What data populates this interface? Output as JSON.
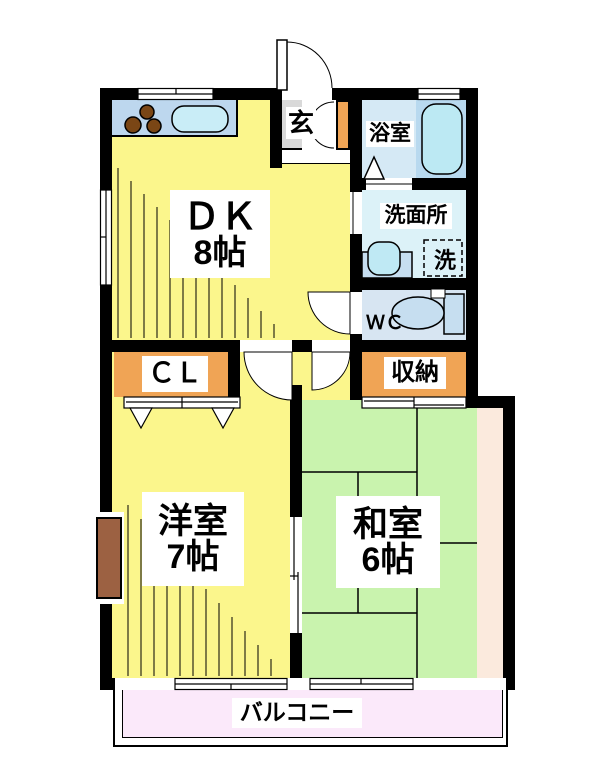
{
  "rooms": {
    "dk": {
      "name": "ＤＫ",
      "size": "8帖"
    },
    "entrance": {
      "label": "玄"
    },
    "bathroom": {
      "label": "浴室"
    },
    "washroom": {
      "label": "洗面所"
    },
    "laundry": {
      "label": "洗"
    },
    "toilet": {
      "label": "ＷＣ"
    },
    "closet": {
      "label": "ＣＬ"
    },
    "storage": {
      "label": "収納"
    },
    "western_room": {
      "name": "洋室",
      "size": "7帖"
    },
    "japanese_room": {
      "name": "和室",
      "size": "6帖"
    },
    "balcony": {
      "label": "バルコニー"
    }
  },
  "colors": {
    "wall_black": "#000000",
    "flooring_yellow": "#FBF68C",
    "tatami_green": "#C9F3AE",
    "tatami_edge_peach": "#FBEADD",
    "balcony_pink": "#FBE9FA",
    "storage_orange": "#F0A455",
    "entry_gray": "#D9D9D9",
    "kitchen_counter_blue": "#BDD7EE",
    "sink_cyan": "#C9EDF7",
    "bathroom_blue": "#D5E9F5",
    "bathtub_zone_blue": "#B8D9EF",
    "bathtub_cyan": "#BCE9F3",
    "washroom_blue": "#DCF2F8",
    "wc_blue": "#D7E5F2",
    "fixture_blue": "#C6DEF0",
    "burner_brown": "#7A4615",
    "wood_box_brown": "#9C6142"
  }
}
